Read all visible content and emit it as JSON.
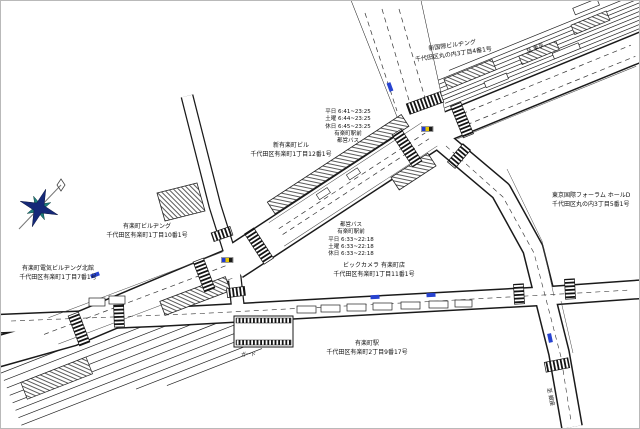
{
  "map_title": "有楽町駅周辺図",
  "buildings": [
    {
      "name": "新国際ビルヂング",
      "address": "千代田区丸の内3丁目4番1号"
    },
    {
      "name": "東京国際フォーラム ホールD",
      "address": "千代田区丸の内3丁目5番1号"
    },
    {
      "name": "新有楽町ビル",
      "address": "千代田区有楽町1丁目12番1号"
    },
    {
      "name": "有楽町ビルヂング",
      "address": "千代田区有楽町1丁目10番1号"
    },
    {
      "name": "有楽町電気ビルヂング北館",
      "address": "千代田区有楽町1丁目7番1号"
    },
    {
      "name": "ビックカメラ 有楽町店",
      "address": "千代田区有楽町1丁目11番1号"
    },
    {
      "name": "有楽町駅",
      "address": "千代田区有楽町2丁目9番17号"
    }
  ],
  "bus_stops": [
    {
      "lines": [
        "平日 6:41~23:25",
        "土曜 6:44~23:25",
        "休日 6:45~23:25",
        "有楽町駅前",
        "都営バス"
      ]
    },
    {
      "lines": [
        "都営バス",
        "有楽町駅前",
        "平日 6:33~22:18",
        "土曜 6:33~22:18",
        "休日 6:33~22:18"
      ]
    }
  ],
  "signs": {
    "to_tokyo": "至 東京",
    "to_ginza": "至 銀座",
    "guard": "ガード"
  },
  "icons": {
    "compass": "compass-rose-icon",
    "bus_marker": "bus-stop-marker",
    "signal_chip": "intersection-marker"
  },
  "colors": {
    "line": "#1a1a1a",
    "compass_primary": "#152878",
    "compass_secondary": "#1e7d7d",
    "bus_marker": "#2743d0",
    "chip_blue": "#1f3bd6",
    "chip_yellow": "#e6c400",
    "chip_dark": "#1a1a1a",
    "frame": "#b9b9b9"
  }
}
